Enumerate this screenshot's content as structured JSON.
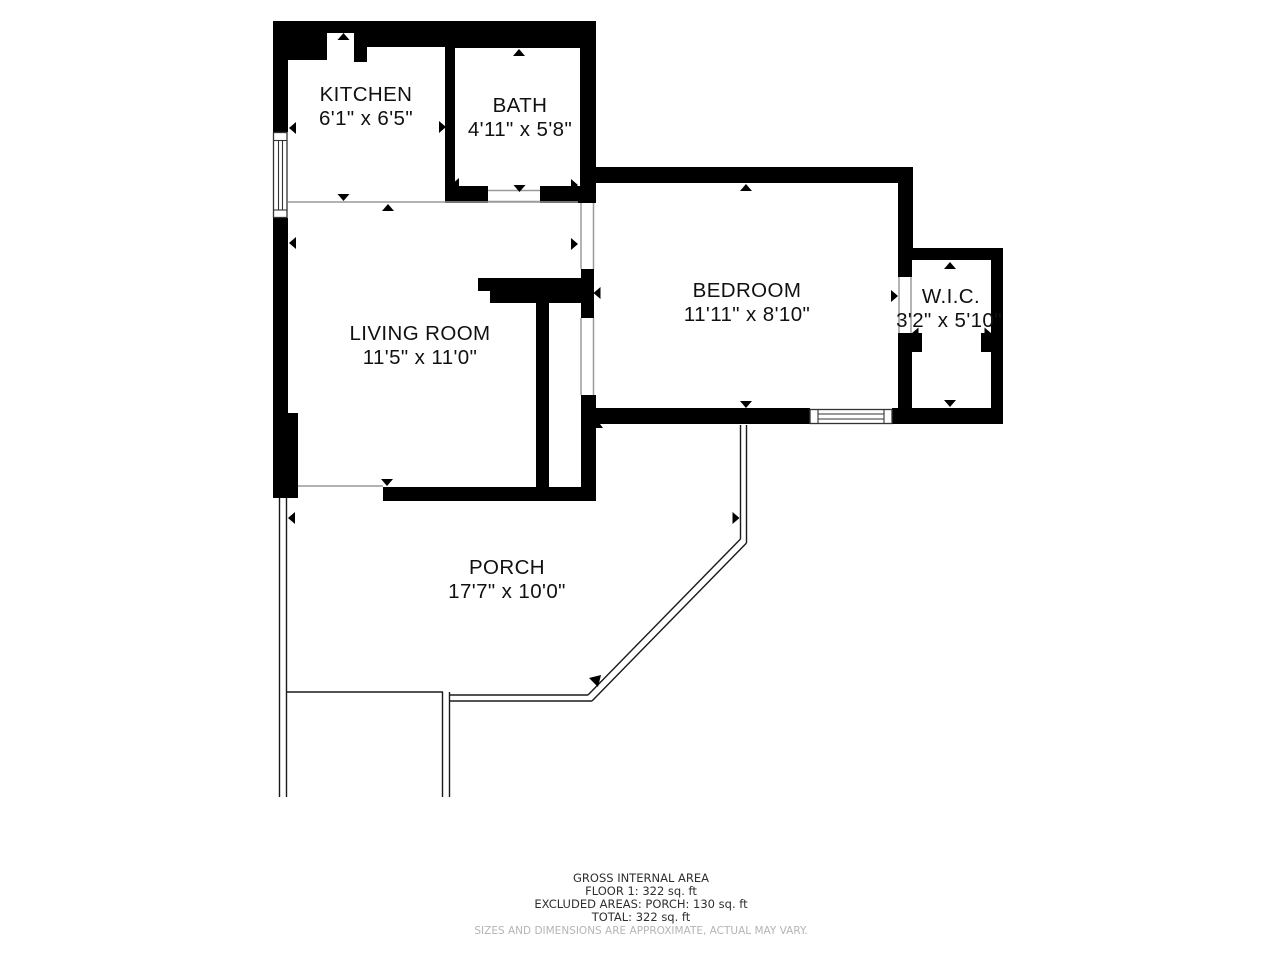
{
  "rooms": [
    {
      "name": "KITCHEN",
      "dims": "6'1\" x 6'5\""
    },
    {
      "name": "BATH",
      "dims": "4'11\" x 5'8\""
    },
    {
      "name": "LIVING ROOM",
      "dims": "11'5\" x 11'0\""
    },
    {
      "name": "BEDROOM",
      "dims": "11'11\" x 8'10\""
    },
    {
      "name": "W.I.C.",
      "dims": "3'2\" x 5'10\""
    },
    {
      "name": "PORCH",
      "dims": "17'7\" x 10'0\""
    }
  ],
  "footer": {
    "title": "GROSS INTERNAL AREA",
    "floor": "FLOOR 1: 322 sq. ft",
    "excluded": "EXCLUDED AREAS: PORCH: 130 sq. ft",
    "total": "TOTAL: 322 sq. ft",
    "disclaimer": "SIZES AND DIMENSIONS ARE APPROXIMATE, ACTUAL MAY VARY."
  },
  "colors": {
    "wall": "#000000",
    "background": "#ffffff",
    "room_text": "#111111",
    "footer_text": "#2f2f2f",
    "disclaimer_text": "#b5b5b5",
    "separator_line": "#9a9a9a"
  }
}
